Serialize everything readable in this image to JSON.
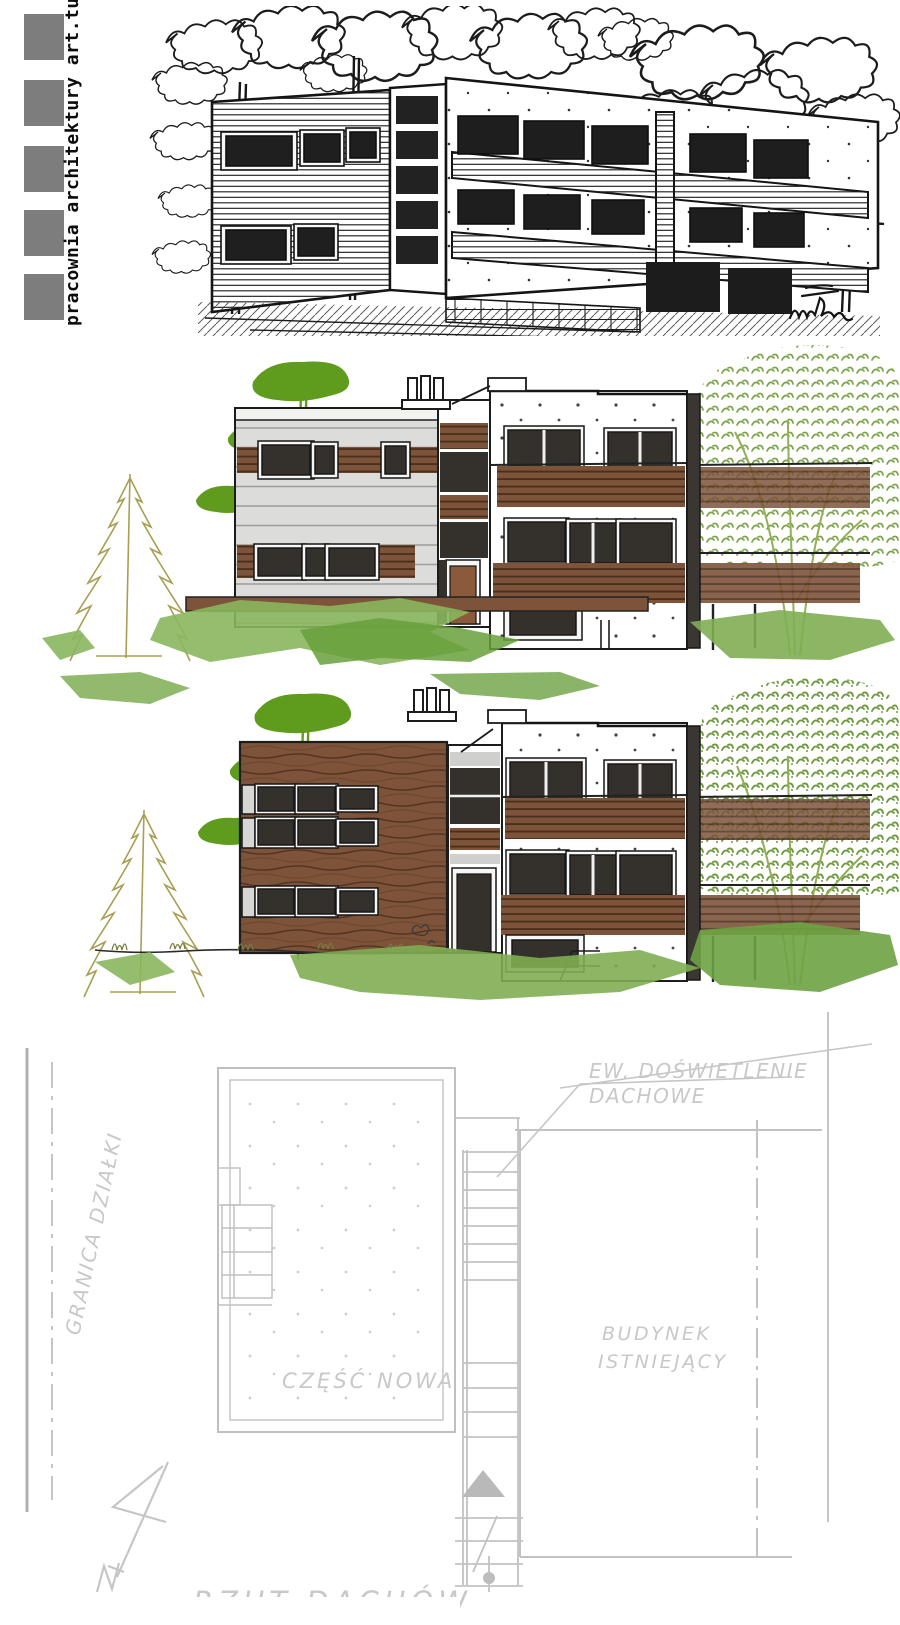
{
  "logo": {
    "text": "pracownia architektury art.tu",
    "square_count": 5,
    "square_color": "#7d7d7d"
  },
  "plan_labels": {
    "skylight_line1": "EW. DOŚWIETLENIE",
    "skylight_line2": "DACHOWE",
    "plot_boundary": "GRANICA DZIAŁKI",
    "new_part": "CZĘŚĆ NOWA",
    "existing_line1": "BUDYNEK",
    "existing_line2": "ISTNIEJĄCY",
    "caption": "RZUT DACHÓW"
  },
  "colors": {
    "ink": "#1c1c1c",
    "pencil": "#c6c6c6",
    "wood": "#7d5339",
    "siding": "#dcdcda",
    "window": "#34312d",
    "pine_green": "#5f9c1d",
    "leaf_green": "#7ca448",
    "olive": "#a89f54",
    "ground_green": "#7fae52"
  }
}
